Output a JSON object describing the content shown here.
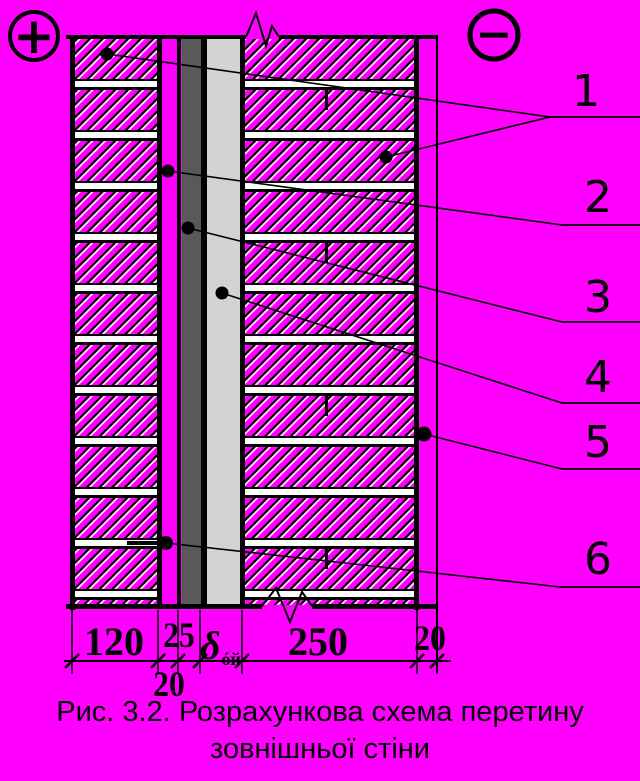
{
  "diagram": {
    "positive_terminal": "+",
    "negative_terminal": "−",
    "callouts": [
      "1",
      "2",
      "3",
      "4",
      "5",
      "6"
    ],
    "dimensions": {
      "outer_brick_layer": "120",
      "air_gap_below": "20",
      "board_layer": "25",
      "insulation_symbol": "δ",
      "insulation_subscript": "óй",
      "inner_masonry": "250",
      "plaster_layer": "20"
    },
    "colors": {
      "background": "#ff00ff",
      "dark_layer": "#595959",
      "light_layer": "#d3d3d3",
      "line": "#000000"
    }
  },
  "caption": {
    "line1": "Рис. 3.2. Розрахункова схема перетину",
    "line2": "зовнішньої стіни"
  }
}
